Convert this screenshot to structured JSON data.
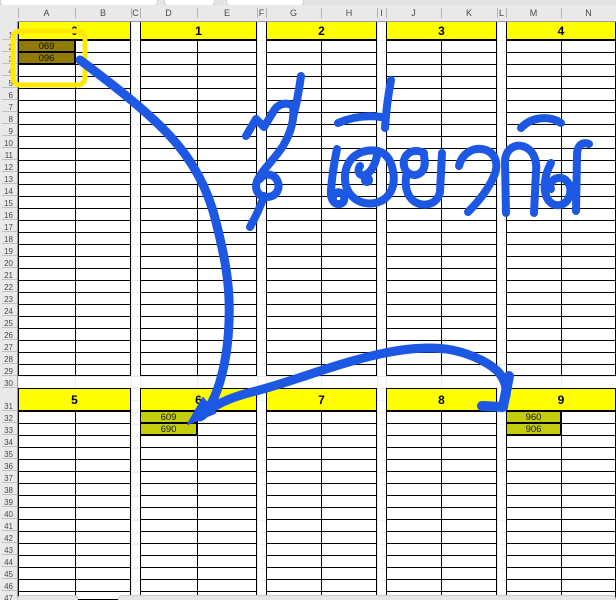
{
  "sheet": {
    "column_letters": [
      "A",
      "B",
      "C",
      "D",
      "E",
      "F",
      "G",
      "H",
      "I",
      "J",
      "K",
      "L",
      "M",
      "N"
    ],
    "row_numbers": [
      "1",
      "2",
      "3",
      "4",
      "5",
      "6",
      "7",
      "8",
      "9",
      "10",
      "11",
      "12",
      "13",
      "14",
      "15",
      "16",
      "17",
      "18",
      "19",
      "20",
      "21",
      "22",
      "23",
      "24",
      "25",
      "26",
      "27",
      "28",
      "29",
      "30",
      "31",
      "32",
      "33",
      "34",
      "35",
      "36",
      "37",
      "38",
      "39",
      "40",
      "41",
      "42",
      "43",
      "44",
      "45",
      "46",
      "47"
    ],
    "top_group_labels": [
      "0",
      "1",
      "2",
      "3",
      "4"
    ],
    "bottom_group_labels": [
      "5",
      "6",
      "7",
      "8",
      "9"
    ],
    "cells": [
      {
        "ref": "A2",
        "value": "069",
        "fill": "dark_olive"
      },
      {
        "ref": "A3",
        "value": "096",
        "fill": "dark_olive"
      },
      {
        "ref": "D32",
        "value": "609",
        "fill": "yellow_green"
      },
      {
        "ref": "D33",
        "value": "690",
        "fill": "yellow_green"
      },
      {
        "ref": "M32",
        "value": "960",
        "fill": "yellow_green"
      },
      {
        "ref": "M33",
        "value": "906",
        "fill": "yellow_green"
      }
    ]
  },
  "annotations": {
    "handwriting_text": "สีเดียวกัน",
    "ink_color": "#1c58e4",
    "highlight_color": "#ffe903"
  },
  "colors": {
    "band_yellow": "#ffff00",
    "dark_olive": "#8f7b06",
    "yellow_green": "#c3cd0e",
    "grid_black": "#000000",
    "chrome_gray": "#e9e9e9"
  }
}
